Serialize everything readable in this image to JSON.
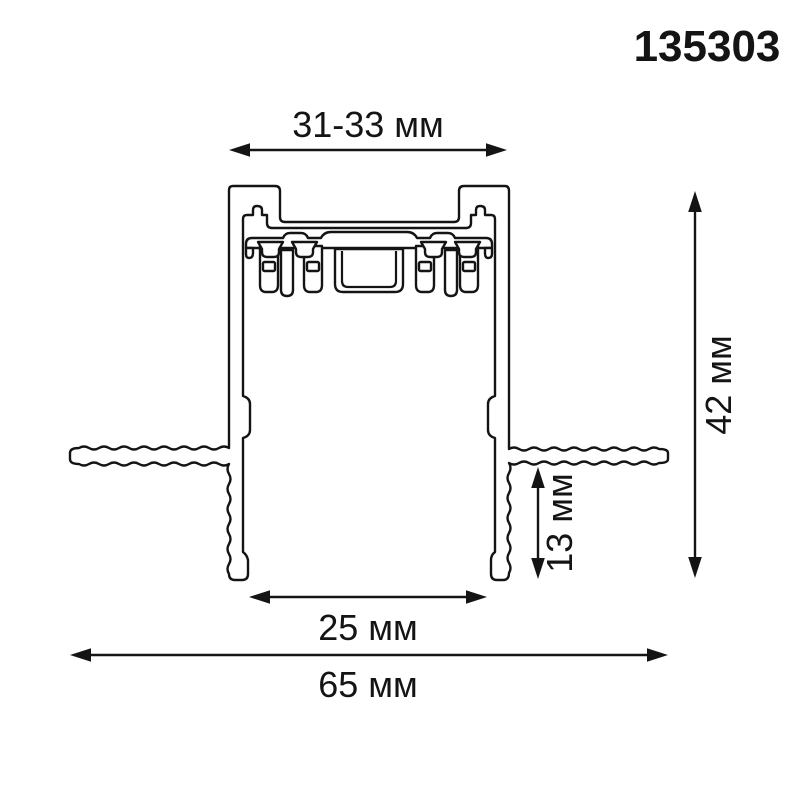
{
  "title_code": "135303",
  "drawing": {
    "type": "technical-cross-section",
    "subject": "recessed mounting track profile",
    "dim_top_width": "31-33 мм",
    "dim_total_height": "42 мм",
    "dim_recess_depth": "13 мм",
    "dim_opening_width": "25 мм",
    "dim_total_width": "65 мм"
  },
  "colors": {
    "line": "#141414",
    "background": "#ffffff"
  }
}
